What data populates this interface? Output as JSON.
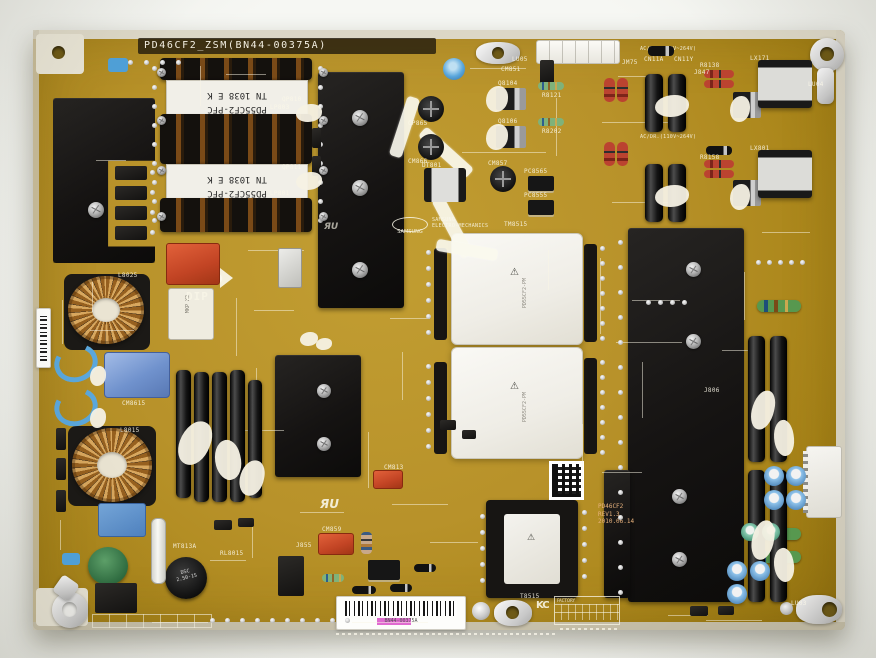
{
  "board": {
    "title": "PD46CF2_ZSM(BN44-00375A)",
    "rev": {
      "model": "PD46CF2",
      "revision": "REV1.3",
      "date": "2010.06.14"
    },
    "pfc_transformer": {
      "line1": "PD55CF2-PFC",
      "line2": "TN 1038 E K"
    },
    "main_transformer_label": "PD55CF2-PM",
    "dip_label": "DIP",
    "samsung_logo": {
      "name": "SAMSUNG",
      "division": "ELECTRO-MECHANICS"
    },
    "ul_mark": "ЯU",
    "kc_mark": "KC",
    "disc_capacitor": {
      "line1": "DSC",
      "line2": "2.50-1S"
    },
    "film_capacitor_label": "MKP X2",
    "barcode_text": "BN44-00375A",
    "factory_table_header": "FACTORY",
    "ac_rating": "AC/DR.(110V~264V)",
    "icons": {
      "warning": "⚠"
    },
    "designators": [
      "LP803",
      "LP801",
      "LX171",
      "LX801",
      "QP810",
      "QP811",
      "Q8104",
      "Q8106",
      "R8121",
      "R8202",
      "CP865",
      "CM866",
      "PC8565",
      "PC8555",
      "DT801",
      "CM8615",
      "L8025",
      "L8015",
      "CM813",
      "CM859",
      "MT813A",
      "RL8015",
      "T8515",
      "CN11A",
      "CN11Y",
      "LU03",
      "LU04",
      "LU05",
      "JM75",
      "J847",
      "J806",
      "J855",
      "TM8515",
      "CM851",
      "R8138",
      "R8158",
      "CM857"
    ]
  }
}
